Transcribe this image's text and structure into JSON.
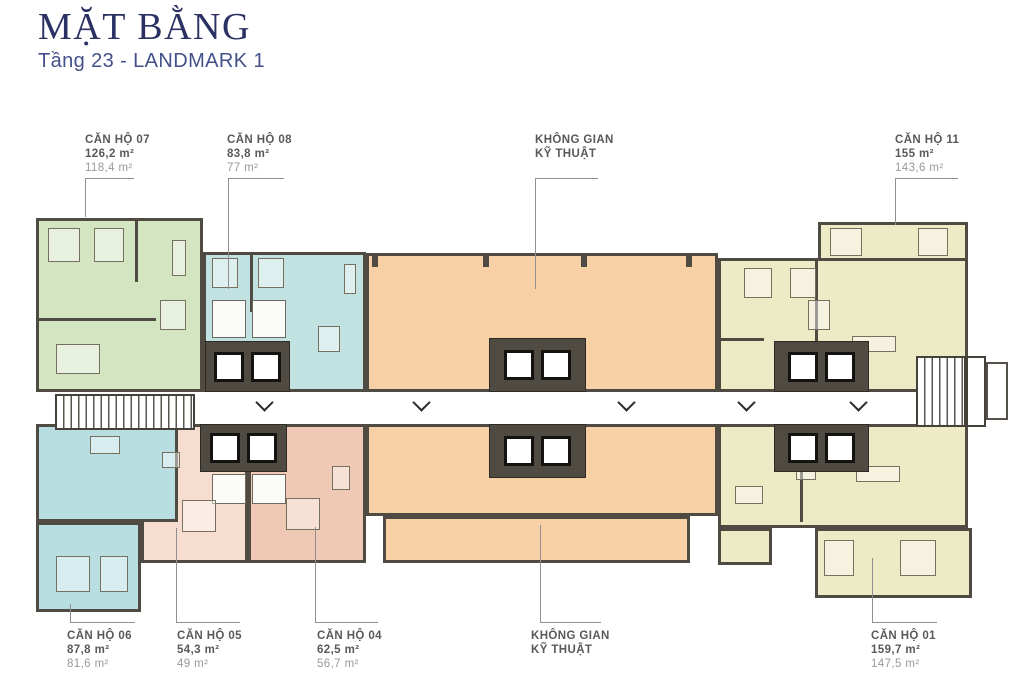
{
  "header": {
    "title": "MẶT BẰNG",
    "subtitle": "Tầng 23 - LANDMARK 1"
  },
  "colors": {
    "title": "#2b3163",
    "subtitle": "#445089",
    "label_primary": "#58595b",
    "label_secondary": "#97999c",
    "wall": "#4f4a42",
    "unit_07": "#d4e6c1",
    "unit_08": "#c2e2e2",
    "unit_06": "#b9dee2",
    "unit_05": "#f7dcd0",
    "unit_04": "#f0c8b6",
    "unit_11": "#edeac6",
    "unit_01": "#edeac6",
    "technical": "#f8d0a6",
    "corridor": "#ffffff",
    "leader": "#8f8f8f"
  },
  "labels": {
    "top": [
      {
        "name": "CĂN HỘ 07",
        "area_gross": "126,2 m²",
        "area_net": "118,4 m²"
      },
      {
        "name": "CĂN HỘ 08",
        "area_gross": "83,8 m²",
        "area_net": "77 m²"
      },
      {
        "line1": "KHÔNG GIAN",
        "line2": "KỸ THUẬT"
      },
      {
        "name": "CĂN HỘ 11",
        "area_gross": "155 m²",
        "area_net": "143,6 m²"
      }
    ],
    "bottom": [
      {
        "name": "CĂN HỘ 06",
        "area_gross": "87,8 m²",
        "area_net": "81,6 m²"
      },
      {
        "name": "CĂN HỘ 05",
        "area_gross": "54,3 m²",
        "area_net": "49 m²"
      },
      {
        "name": "CĂN HỘ 04",
        "area_gross": "62,5 m²",
        "area_net": "56,7 m²"
      },
      {
        "line1": "KHÔNG GIAN",
        "line2": "KỸ THUẬT"
      },
      {
        "name": "CĂN HỘ 01",
        "area_gross": "159,7 m²",
        "area_net": "147,5 m²"
      }
    ]
  }
}
